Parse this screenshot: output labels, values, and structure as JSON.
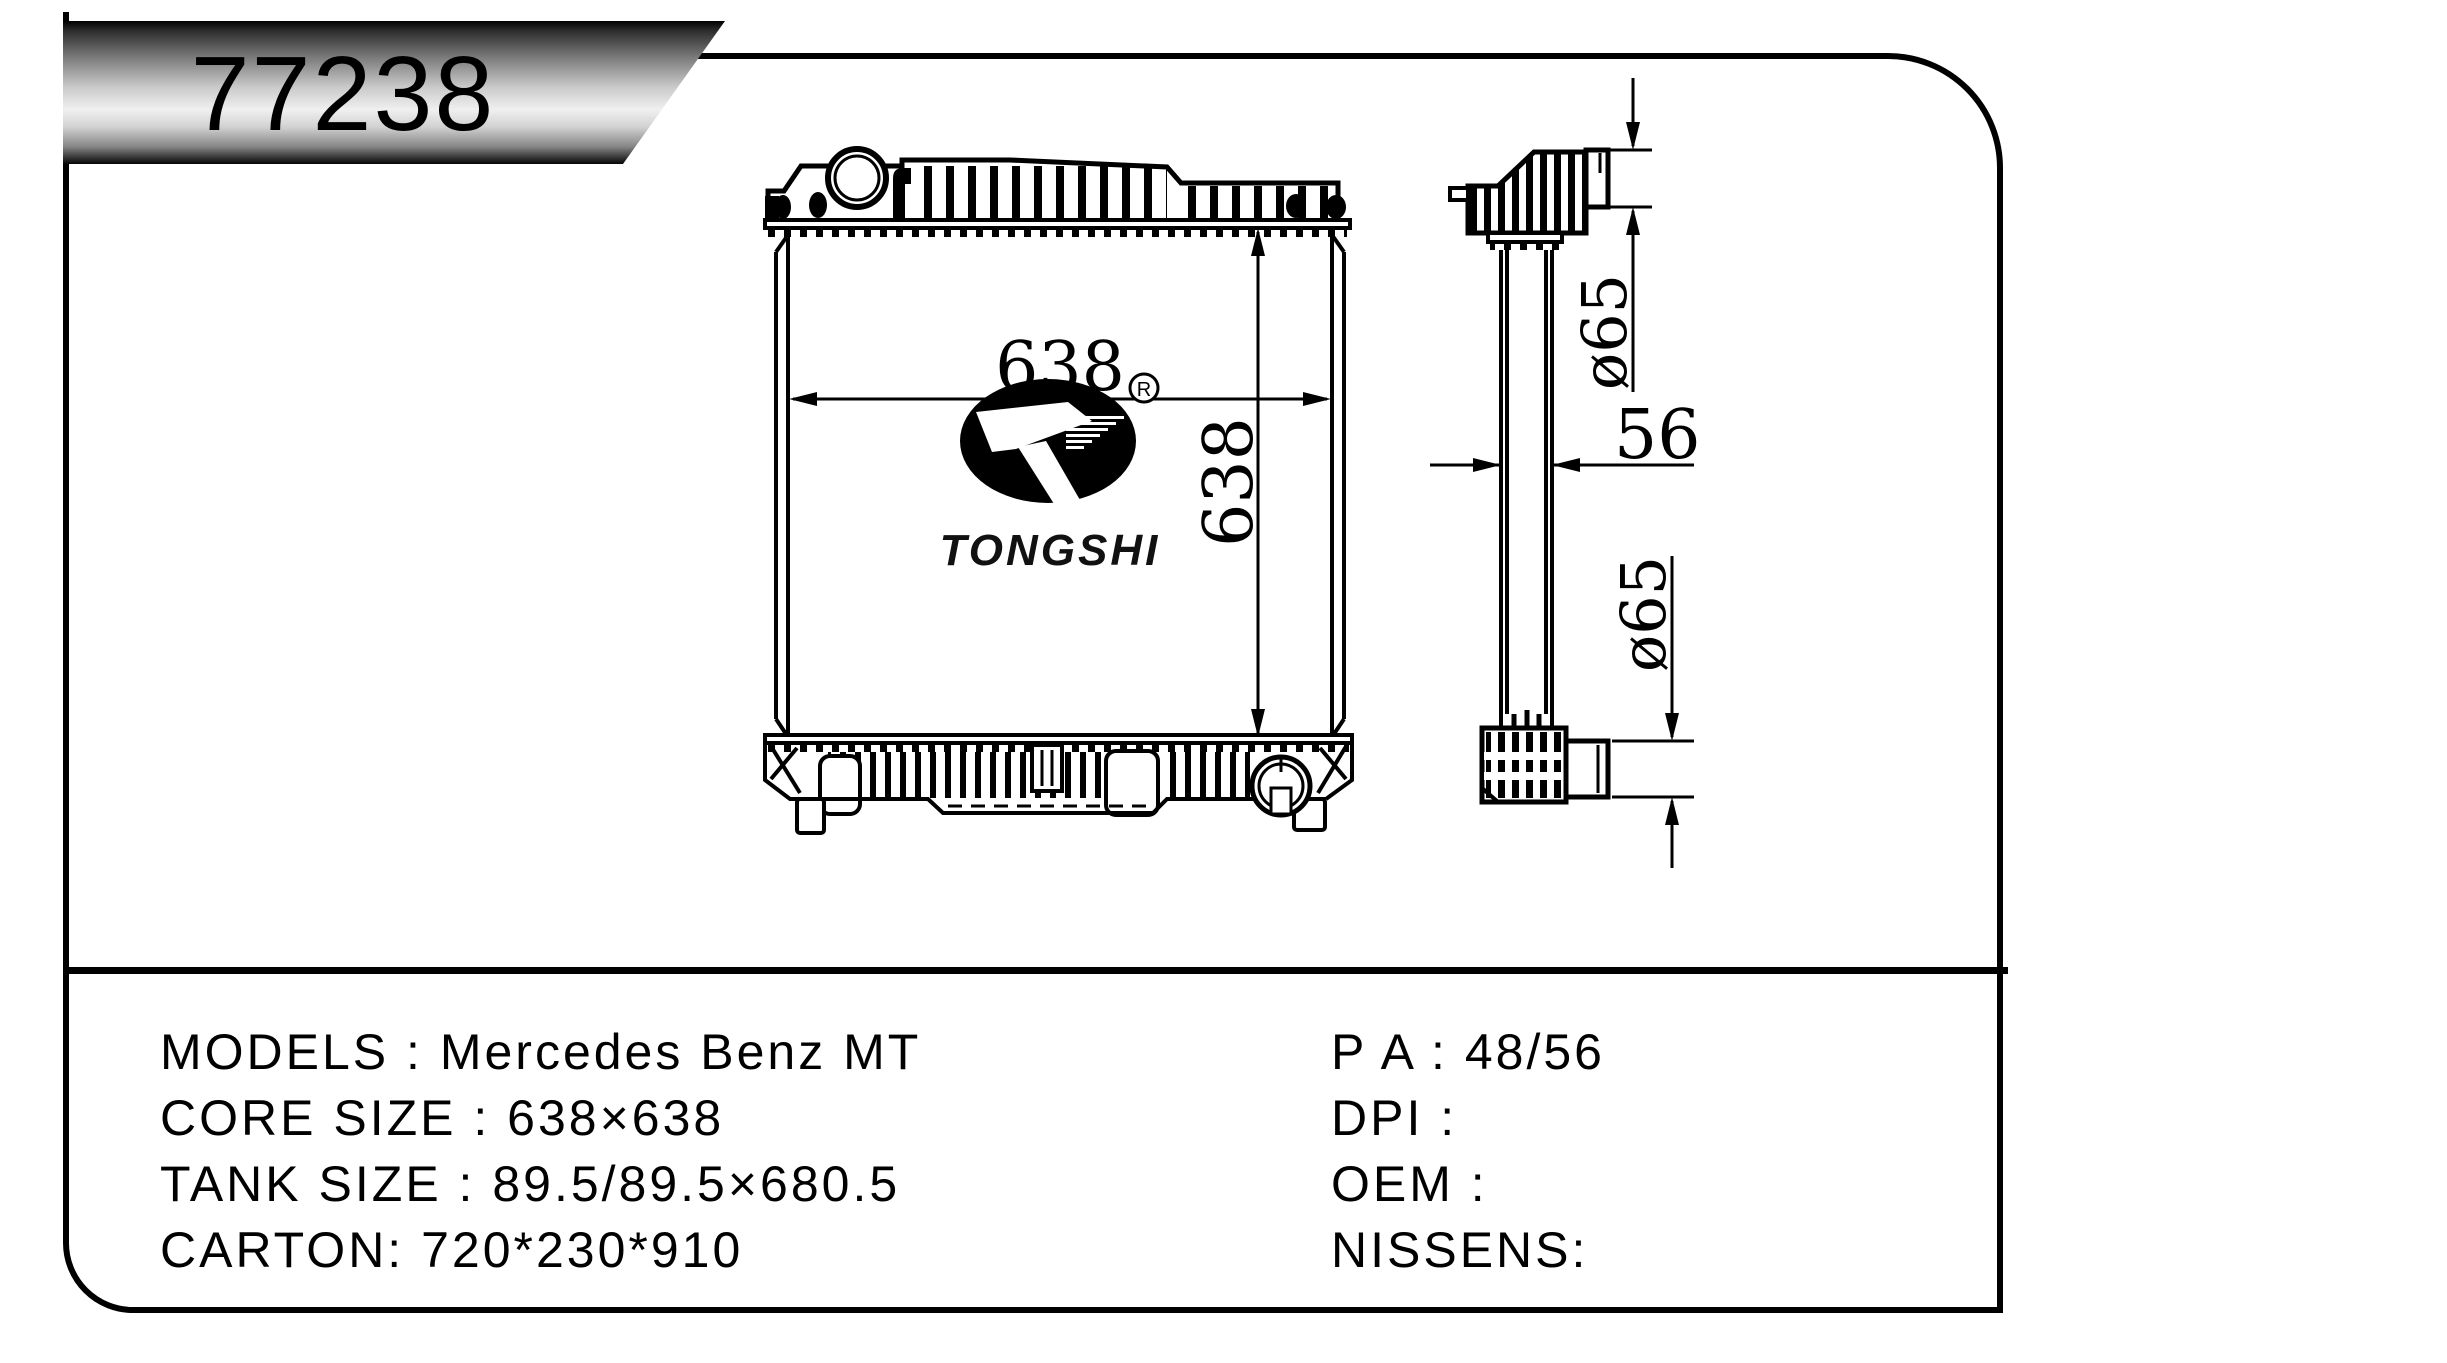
{
  "badge": {
    "part_number": "77238"
  },
  "drawing": {
    "front_view": {
      "width_dim": "638",
      "height_dim": "638"
    },
    "side_view": {
      "thickness_dim": "56",
      "inlet_diameter_dim": "ø65",
      "outlet_diameter_dim": "ø65"
    },
    "logo": {
      "brand": "TONGSHI",
      "registered": "R"
    }
  },
  "specs": {
    "left_column": [
      {
        "text": "MODELS : Mercedes Benz MT"
      },
      {
        "text": "CORE SIZE : 638×638"
      },
      {
        "text": "TANK SIZE : 89.5/89.5×680.5"
      },
      {
        "text": "CARTON: 720*230*910"
      }
    ],
    "right_column": [
      {
        "text": "P A : 48/56"
      },
      {
        "text": "DPI :"
      },
      {
        "text": "OEM :"
      },
      {
        "text": "NISSENS:"
      }
    ]
  }
}
